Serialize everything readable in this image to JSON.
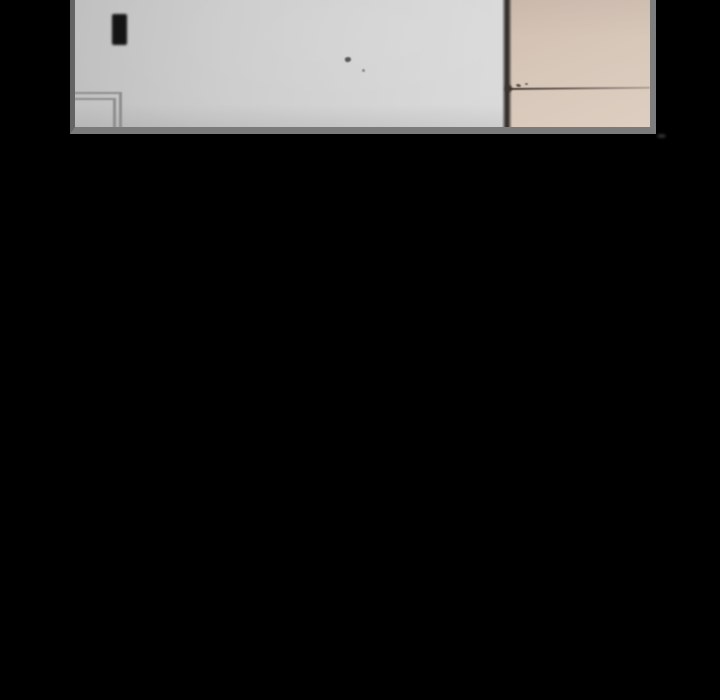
{
  "page": {
    "background_color": "#000000",
    "description": "Black reader viewport with one blurred comic panel strip at the top"
  },
  "panel": {
    "description": "Blurred interior scene: light gray wall with black light switch and door-frame corner on the left, dark wall corner line, beige wall with thin horizontal seam line and small specks on the right",
    "elements": [
      "left-wall",
      "light-switch",
      "door-frame-corner",
      "wall-speck",
      "wall-corner-line",
      "right-wall",
      "wall-seam-line",
      "seam-specks"
    ]
  },
  "colors": {
    "bg": "#000000",
    "borderLeft": "#646464",
    "borderRight": "#7e7e7e",
    "borderBottom": "#7b7b7b",
    "wallGrayDark": "#bfbfbf",
    "wallGrayLight": "#d9d9d9",
    "wallBeigeTop": "#d1bfb1",
    "wallBeigeBottom": "#ddcec1",
    "cornerLine": "#37312e",
    "seamDark": "#463d38",
    "seamLight": "#b0a296",
    "frameLine": "#8e8e8e",
    "switch": "#141414",
    "speck": "#565656"
  }
}
